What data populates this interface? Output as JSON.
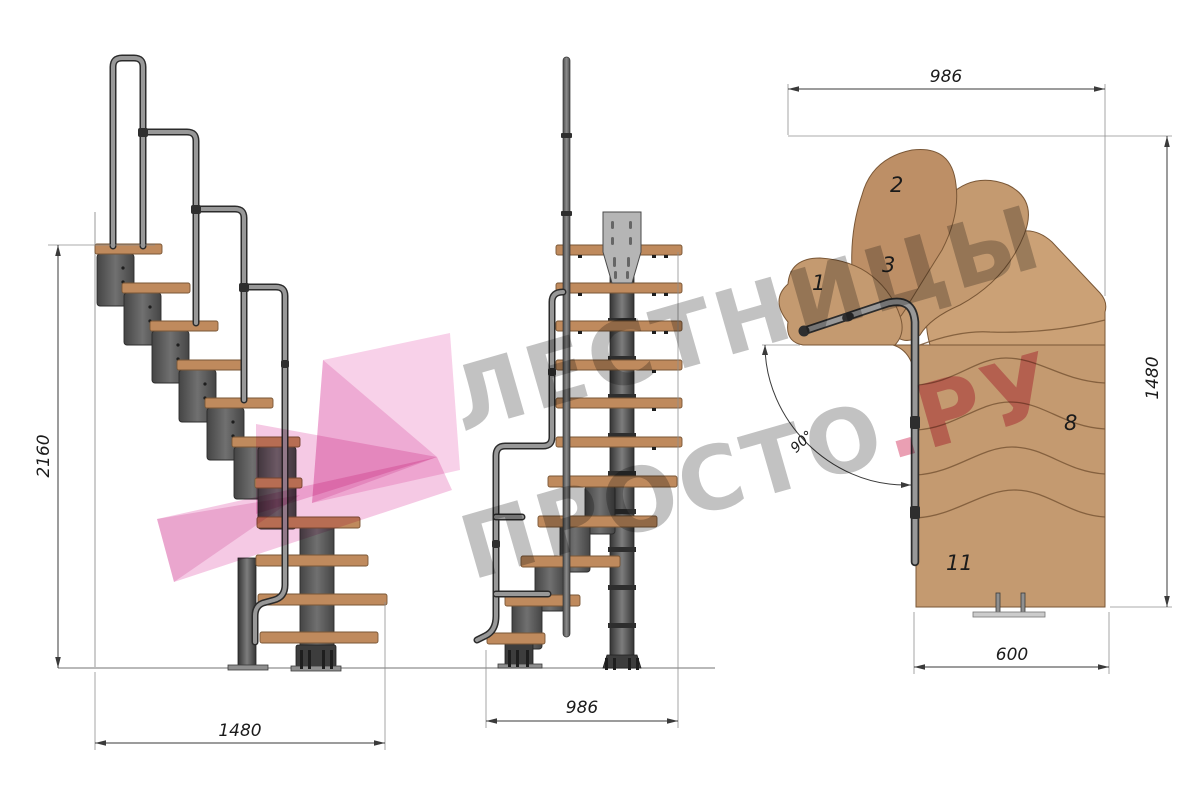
{
  "watermark": {
    "line1": "ЛЕСТНИЦЫ",
    "line2": "ПРОСТО",
    "line2_accent": ".РУ"
  },
  "side_view": {
    "height_dim": "2160",
    "width_dim": "1480"
  },
  "front_view": {
    "depth_dim": "986"
  },
  "plan_view": {
    "width_dim": "986",
    "length_dim": "1480",
    "bottom_dim": "600",
    "angle_dim": "90°",
    "step_labels": [
      "1",
      "2",
      "3",
      "8",
      "11"
    ]
  },
  "colors": {
    "background": "#ffffff",
    "wood": "#c49a70",
    "wood_alt": "#cba176",
    "wood_alt2": "#bd8f66",
    "wood_side": "#bf8a5d",
    "wood_edge": "#7a5736",
    "plate": "#b5b5b5",
    "pipe": "#989898",
    "dimension": "#3a3a3a",
    "watermark_gray": "#909090",
    "watermark_pink": "#f5c2e1",
    "watermark_pink_text": "#d84f74"
  }
}
